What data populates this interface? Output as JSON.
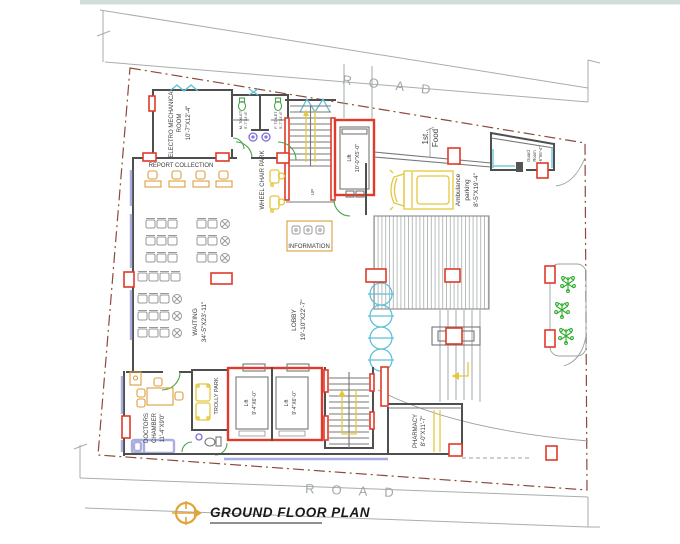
{
  "title": {
    "text": "GROUND FLOOR PLAN"
  },
  "roads": {
    "top": "ROAD",
    "bottom": "ROAD"
  },
  "colors": {
    "walls": "#4f4f4f",
    "columns": "#e03a2a",
    "boundary": "#8a4a3c",
    "furniture": "#dd9e3e",
    "doors": "#4aa34a",
    "windows": "#5ec1d8",
    "highlight": "#e3c83e",
    "fixtures": "#7b6fd8",
    "trees": "#2fae2f",
    "road_text": "#a3a8a8",
    "title_text": "#1a1a1a"
  },
  "labels": {
    "electro1": "ELECTRO MECHANICAL",
    "electro2": "ROOM",
    "electro_dims": "10'-7\"X12'-4\"",
    "report": "REPORT COLLECTION",
    "wheelchair": "WHEEL CHAIR PARK",
    "information": "INFORMATION",
    "m_toilet": "M. TOILET",
    "m_toilet_dims": "5'-7\"X4'-6\"",
    "f_toilet": "F. TOILET",
    "f_toilet_dims": "5'-7\"X4'-6\"",
    "lift_top": "Lift",
    "lift_top_dims": "10'-0\"X5'-0\"",
    "stairs_up": "UP",
    "food1": "1st.",
    "food2": "Food",
    "guard1": "Guard",
    "guard2": "Room",
    "guard_dims": "5'-6\"X6'-4\"",
    "amb1": "Ambulance",
    "amb2": "parking",
    "amb_dims": "8'-5\"X19'-4\"",
    "waiting": "WAITING",
    "waiting_dims": "34'-5\"X23'-11\"",
    "lobby": "LOBBY",
    "lobby_dims": "19'-10\"X22'-7\"",
    "doc1": "DOCTORS",
    "doc2": "CHAMBER",
    "doc_dims": "11'-4\"X9'0\"",
    "trolly": "TROLLY PARK",
    "lift_b": "Lift",
    "lift_b_dims": "9'-4\"X6'-0\"",
    "pharmacy": "PHARMACY",
    "pharmacy_dims": "8'-0\"X11'-7\""
  }
}
